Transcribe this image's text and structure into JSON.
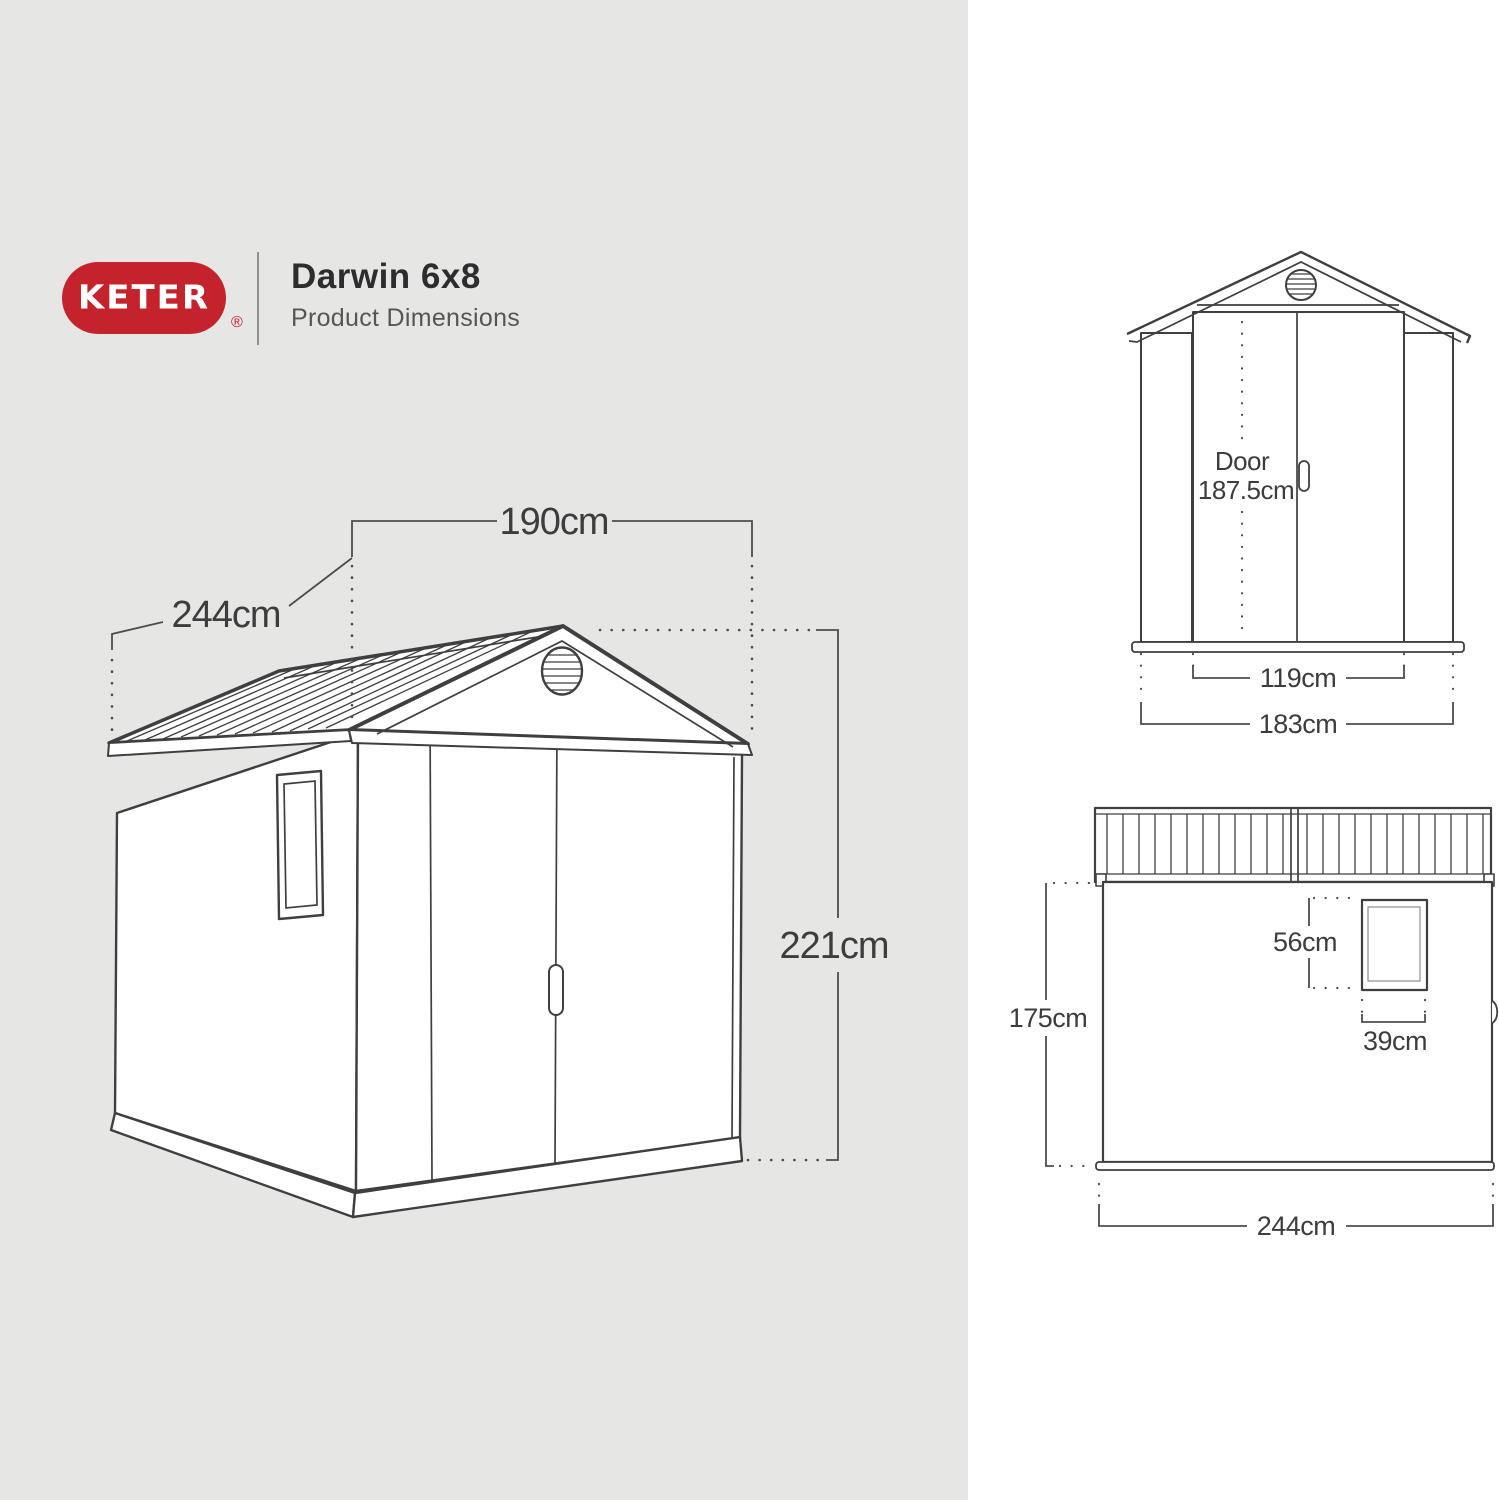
{
  "header": {
    "brand": "KETER",
    "registered_mark": "®",
    "product_name": "Darwin 6x8",
    "subtitle": "Product Dimensions"
  },
  "views": {
    "perspective": {
      "width_label": "190cm",
      "depth_label": "244cm",
      "height_label": "221cm"
    },
    "front": {
      "door_line1": "Door",
      "door_line2": "187.5cm",
      "door_width_label": "119cm",
      "overall_width_label": "183cm"
    },
    "side": {
      "window_height_label": "56cm",
      "window_width_label": "39cm",
      "wall_height_label": "175cm",
      "depth_label": "244cm"
    }
  },
  "colors": {
    "brand_red": "#C4232B",
    "panel_gray": "#E6E6E5",
    "panel_white": "#FFFFFF",
    "line_dark": "#3F3F3F",
    "dimension_gray": "#4D4D4D",
    "text_dark": "#3D3D3D"
  }
}
